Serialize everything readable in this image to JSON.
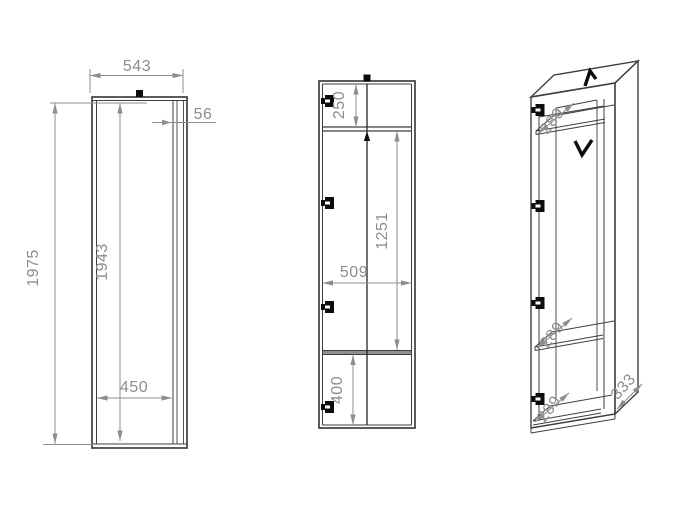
{
  "colors": {
    "background": "#ffffff",
    "outline": "#3f3f3f",
    "inner_line": "#4a4a4a",
    "dimension": "#8d8d8d",
    "hardware": "#0c0c0c",
    "shelf_fill": "#8f8f8f"
  },
  "views": {
    "front": {
      "dim_width": "543",
      "dim_edge_strip": "56",
      "dim_height_outer": "1975",
      "dim_height_inner": "1943",
      "dim_width_inner": "450"
    },
    "section": {
      "dim_top_compartment": "250",
      "dim_main_compartment": "1251",
      "dim_inner_width": "509",
      "dim_bottom_compartment": "400"
    },
    "isometric": {
      "dim_top_shelf_depth": "289",
      "dim_middle_shelf_depth": "289",
      "dim_bottom_shelf_depth": "289",
      "dim_side_depth": "333"
    }
  }
}
